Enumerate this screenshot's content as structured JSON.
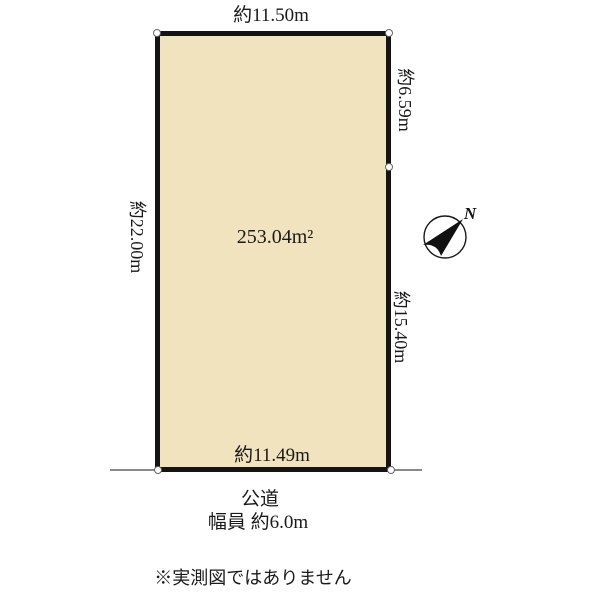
{
  "plot": {
    "area_label": "253.04m²",
    "top_dim": "約11.50m",
    "left_dim": "約22.00m",
    "right_upper_dim": "約6.59m",
    "right_lower_dim": "約15.40m",
    "bottom_dim": "約11.49m",
    "fill_color": "#F1E3BE",
    "border_color": "#141414"
  },
  "road": {
    "name": "公道",
    "width_label": "幅員 約6.0m",
    "edge_line_color": "#8a8a8a"
  },
  "compass": {
    "north_label": "N"
  },
  "note": "※実測図ではありません"
}
